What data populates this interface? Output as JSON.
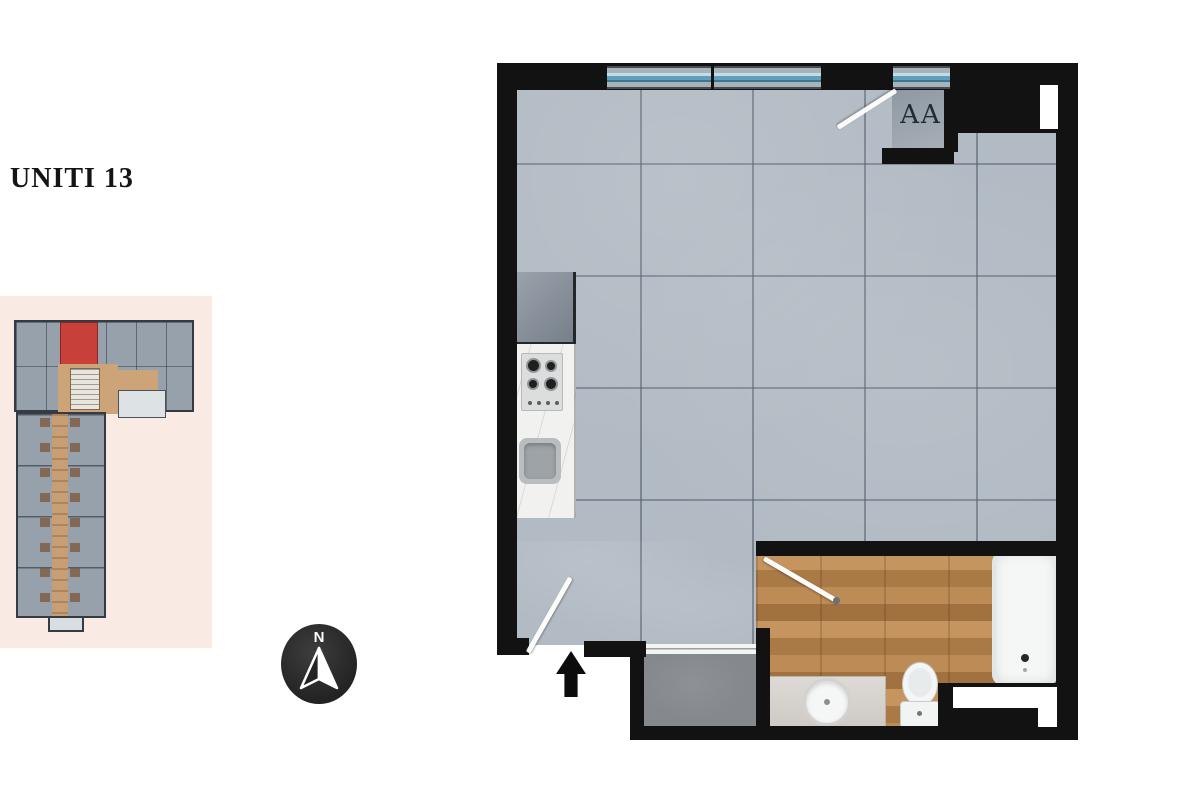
{
  "page": {
    "width": 1200,
    "height": 800,
    "background": "#ffffff"
  },
  "title": {
    "text": "UNITI 13",
    "color": "#141414"
  },
  "mini_map": {
    "background": "#f9eae4",
    "building_color": "#96a1ac",
    "wall_color": "#343b42",
    "corridor_color": "#cda378",
    "highlighted_unit_color": "#c8403a"
  },
  "compass": {
    "letter": "N",
    "circle_color": "#2b2b2b",
    "arrow_color": "#ffffff"
  },
  "main_plan": {
    "closet_label": "AA",
    "colors": {
      "wall": "#121212",
      "tile_floor": "#b2bac3",
      "closet_floor": "#9aa3ac",
      "terrace_floor": "#85898e",
      "bathroom_wood_floor": "#b07e4e",
      "window_glass": "#61a0bd",
      "kitchen_counter": "#f1f1ef",
      "fixture_white": "#f5f7f7"
    }
  },
  "icons": {
    "north_arrow_icon": "▲",
    "entry_arrow_icon": "↑"
  }
}
